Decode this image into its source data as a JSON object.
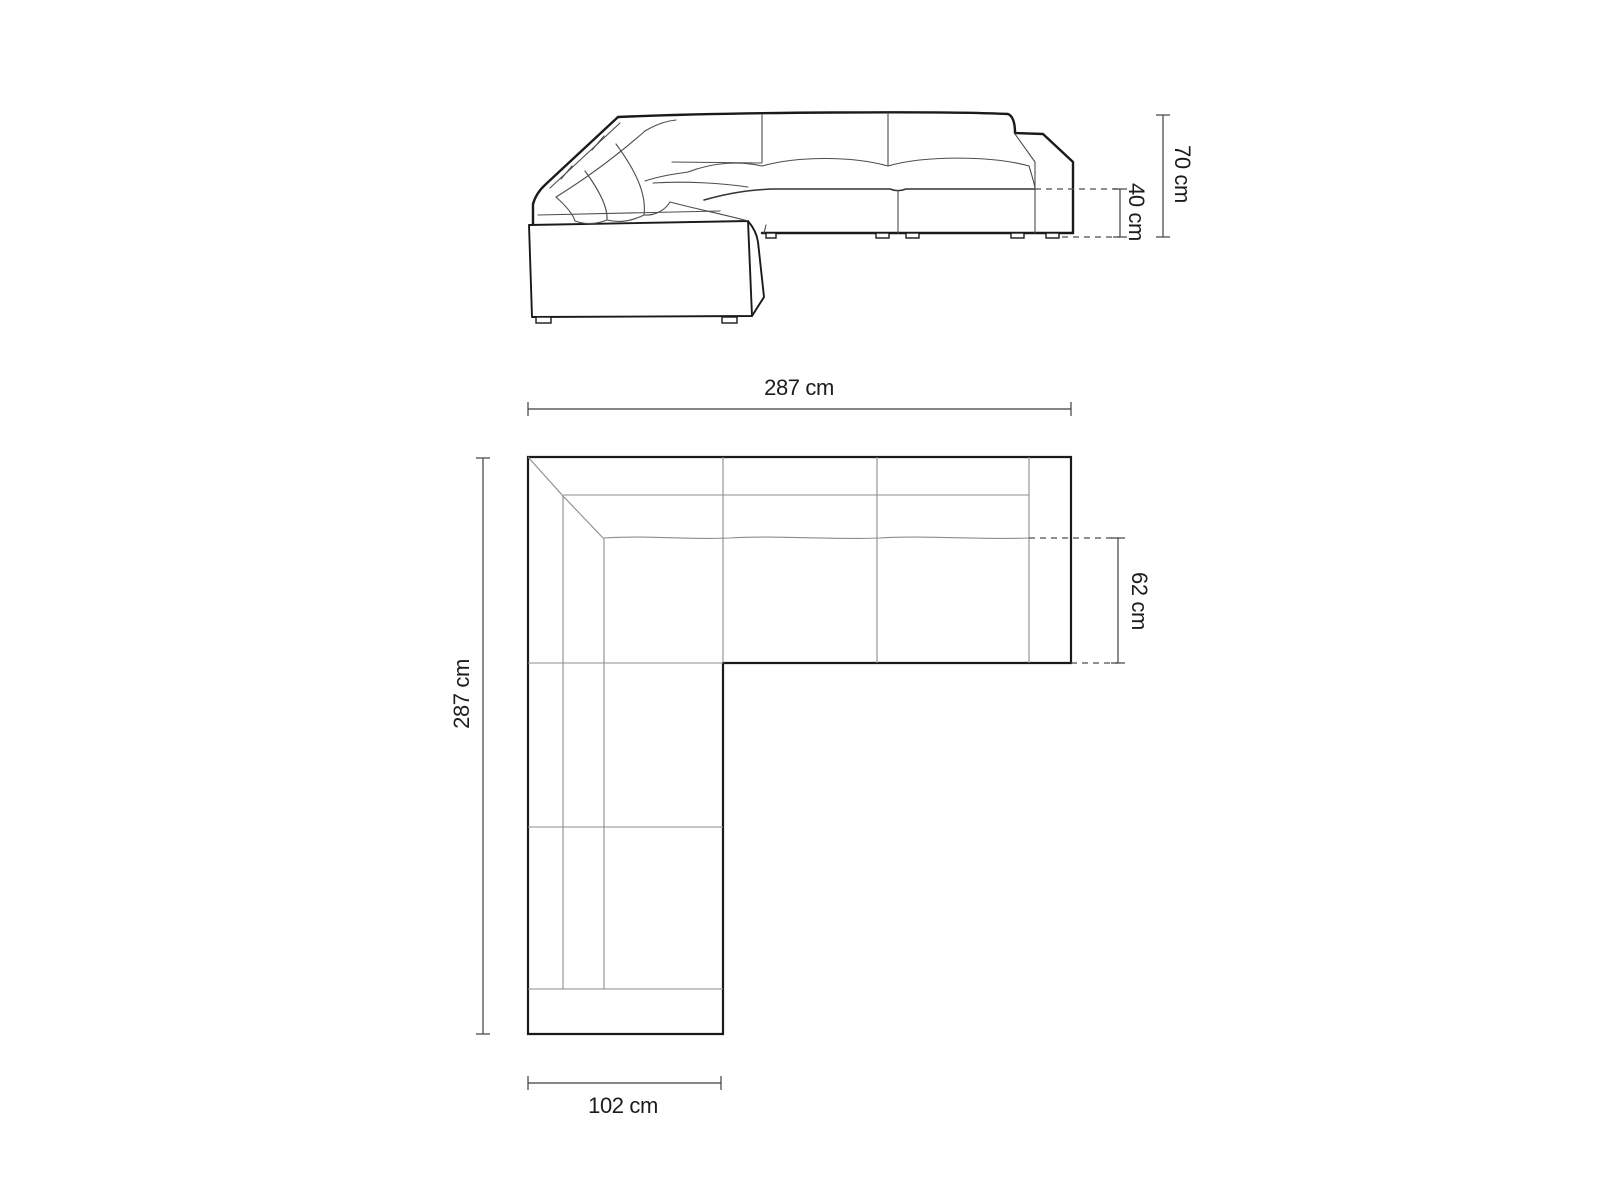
{
  "diagram": {
    "title": "corner-sofa-dimension-drawing",
    "views": {
      "front_elevation": {
        "dimensions": {
          "total_height": "70 cm",
          "seat_height": "40 cm"
        }
      },
      "top_plan": {
        "dimensions": {
          "total_width": "287 cm",
          "total_depth": "287 cm",
          "seat_depth": "62 cm",
          "chaise_width": "102 cm"
        }
      }
    },
    "colors": {
      "background": "#ffffff",
      "outline": "#1a1a1a",
      "seam": "#8c8c8c",
      "detail": "#4d4d4d",
      "dimension_line": "#3f3f3f",
      "label_text": "#1c1c1c"
    }
  }
}
